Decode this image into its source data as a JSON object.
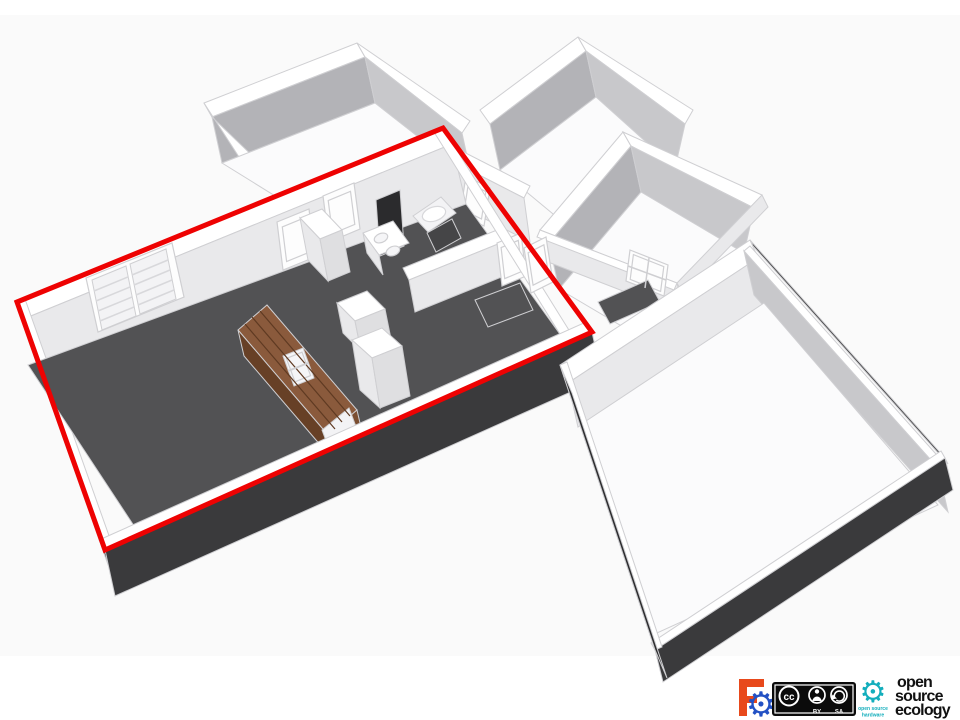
{
  "palette": {
    "wallTop": "#ffffff",
    "faceShadow": "#b3b3b7",
    "faceMed": "#c8c8cb",
    "faceMedLight": "#dfdfe1",
    "faceLight": "#e9e9eb",
    "floorWhite": "#fbfbfc",
    "floorDark": "#525254",
    "floorDark2": "#454547",
    "extDark": "#3a3a3c",
    "extDarker": "#2d2d2f",
    "doorWhite": "#fdfdfd",
    "whiteSoft": "#f3f3f5",
    "wood": "#8a5a3c",
    "woodMed": "#7b4e31",
    "woodDark": "#674026",
    "woodLine": "#5f3a22",
    "sinkWhite": "#f5f5f7",
    "darkPanel": "#2b2b2d",
    "frameStroke": "#cfcfd2",
    "slatStroke": "#d8d8db",
    "white": "#ffffff",
    "red": "#ee0202",
    "ccBlack": "#0b0b0b",
    "oshwTeal": "#13aebc",
    "fcOrange": "#e8491b",
    "fcBlue": "#2351c4",
    "oseBlack": "#111111"
  },
  "annotation": {
    "highlight_color": "#ee0202"
  },
  "footer": {
    "freecad": {
      "gear_icon": "⚙"
    },
    "cc": {
      "cc_label": "cc",
      "by_label": "BY",
      "sa_label": "SA"
    },
    "oshw": {
      "gear_icon": "⚙",
      "line1": "open source",
      "line2": "hardware"
    },
    "ose": {
      "words": [
        "open",
        "source",
        "ecology"
      ]
    }
  }
}
